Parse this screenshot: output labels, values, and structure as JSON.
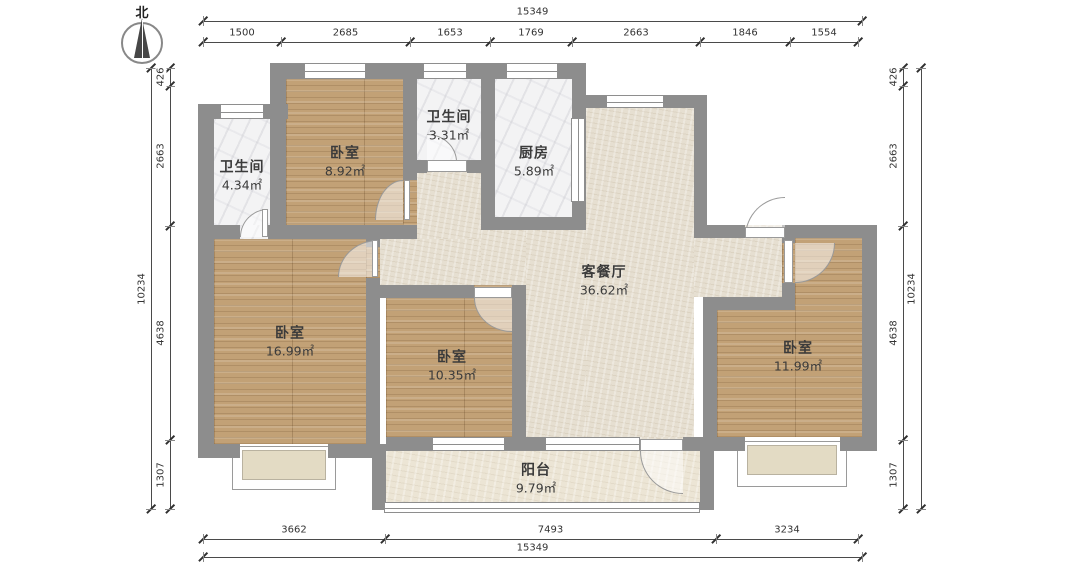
{
  "north": {
    "label": "北"
  },
  "colors": {
    "wall": "#8d8d8d",
    "wood_floor": "#c2a176",
    "tile_floor": "#f3f3f4",
    "living_floor": "#e6dfd1",
    "balcony_floor": "#ece5d5",
    "dim_line": "#4a4a4a",
    "label_text": "#3b3b3b"
  },
  "rooms": [
    {
      "id": "bath-master",
      "name": "卫生间",
      "area": "4.34㎡",
      "label": [
        242,
        176
      ],
      "floor_type": "tile",
      "floors": [
        [
          214,
          119,
          56,
          106
        ],
        [
          240,
          225,
          28,
          14
        ]
      ]
    },
    {
      "id": "bedroom-north",
      "name": "卧室",
      "area": "8.92㎡",
      "label": [
        345,
        162
      ],
      "floor_type": "wood",
      "floors": [
        [
          286,
          79,
          117,
          146
        ],
        [
          403,
          180,
          14,
          45
        ]
      ]
    },
    {
      "id": "bath-common",
      "name": "卫生间",
      "area": "3.31㎡",
      "label": [
        449,
        126
      ],
      "floor_type": "tile",
      "floors": [
        [
          417,
          79,
          64,
          81
        ]
      ]
    },
    {
      "id": "kitchen",
      "name": "厨房",
      "area": "5.89㎡",
      "label": [
        534,
        162
      ],
      "floor_type": "tile",
      "floors": [
        [
          495,
          79,
          77,
          138
        ]
      ]
    },
    {
      "id": "living-dining",
      "name": "客餐厅",
      "area": "36.62㎡",
      "label": [
        604,
        281
      ],
      "floor_type": "living",
      "floors": [
        [
          586,
          108,
          108,
          329
        ],
        [
          526,
          230,
          60,
          207
        ],
        [
          481,
          230,
          45,
          55
        ],
        [
          481,
          285,
          31,
          152
        ],
        [
          417,
          173,
          64,
          66
        ],
        [
          380,
          239,
          101,
          46
        ],
        [
          694,
          238,
          88,
          59
        ],
        [
          427,
          160,
          40,
          13
        ],
        [
          745,
          225,
          40,
          13
        ],
        [
          640,
          437,
          43,
          14
        ]
      ]
    },
    {
      "id": "bedroom-master",
      "name": "卧室",
      "area": "16.99㎡",
      "label": [
        290,
        342
      ],
      "floor_type": "wood",
      "floors": [
        [
          214,
          239,
          152,
          205
        ],
        [
          366,
          247,
          14,
          31
        ]
      ]
    },
    {
      "id": "bedroom-middle",
      "name": "卧室",
      "area": "10.35㎡",
      "label": [
        452,
        366
      ],
      "floor_type": "wood",
      "floors": [
        [
          386,
          298,
          126,
          139
        ],
        [
          474,
          285,
          38,
          13
        ]
      ]
    },
    {
      "id": "bedroom-east",
      "name": "卧室",
      "area": "11.99㎡",
      "label": [
        798,
        357
      ],
      "floor_type": "wood",
      "floors": [
        [
          795,
          238,
          67,
          72
        ],
        [
          717,
          310,
          145,
          127
        ],
        [
          782,
          243,
          13,
          40
        ]
      ]
    },
    {
      "id": "balcony",
      "name": "阳台",
      "area": "9.79㎡",
      "label": [
        536,
        479
      ],
      "floor_type": "balcony",
      "floors": [
        [
          386,
          451,
          314,
          54
        ]
      ]
    }
  ],
  "walls": [
    [
      198,
      104,
      90,
      15
    ],
    [
      198,
      104,
      16,
      354
    ],
    [
      270,
      63,
      16,
      176
    ],
    [
      286,
      63,
      300,
      16
    ],
    [
      572,
      63,
      14,
      167
    ],
    [
      586,
      95,
      121,
      13
    ],
    [
      694,
      95,
      13,
      143
    ],
    [
      694,
      225,
      51,
      13
    ],
    [
      785,
      225,
      92,
      13
    ],
    [
      862,
      225,
      15,
      226
    ],
    [
      198,
      444,
      42,
      14
    ],
    [
      328,
      444,
      58,
      14
    ],
    [
      372,
      444,
      14,
      66
    ],
    [
      386,
      437,
      46,
      14
    ],
    [
      505,
      437,
      40,
      14
    ],
    [
      683,
      437,
      34,
      14
    ],
    [
      700,
      451,
      14,
      59
    ],
    [
      703,
      437,
      42,
      14
    ],
    [
      840,
      437,
      37,
      14
    ],
    [
      403,
      79,
      14,
      101
    ],
    [
      286,
      225,
      131,
      14
    ],
    [
      214,
      225,
      26,
      14
    ],
    [
      268,
      225,
      18,
      14
    ],
    [
      417,
      160,
      10,
      13
    ],
    [
      467,
      160,
      28,
      13
    ],
    [
      481,
      79,
      14,
      151
    ],
    [
      481,
      217,
      105,
      13
    ],
    [
      366,
      239,
      14,
      8
    ],
    [
      366,
      278,
      14,
      166
    ],
    [
      366,
      285,
      108,
      13
    ],
    [
      512,
      285,
      14,
      13
    ],
    [
      512,
      285,
      14,
      152
    ],
    [
      703,
      297,
      92,
      13
    ],
    [
      703,
      310,
      14,
      127
    ],
    [
      782,
      225,
      13,
      18
    ],
    [
      782,
      283,
      13,
      27
    ]
  ],
  "bays": [
    {
      "frame": [
        232,
        446,
        104,
        44
      ],
      "inner": [
        242,
        450,
        84,
        30
      ]
    },
    {
      "frame": [
        737,
        441,
        110,
        46
      ],
      "inner": [
        747,
        445,
        90,
        30
      ]
    }
  ],
  "windows": [
    {
      "r": [
        220,
        104,
        44,
        15
      ],
      "dir": "h"
    },
    {
      "r": [
        304,
        63,
        62,
        16
      ],
      "dir": "h"
    },
    {
      "r": [
        423,
        63,
        44,
        16
      ],
      "dir": "h"
    },
    {
      "r": [
        506,
        63,
        52,
        16
      ],
      "dir": "h"
    },
    {
      "r": [
        606,
        95,
        58,
        13
      ],
      "dir": "h"
    },
    {
      "r": [
        571,
        118,
        14,
        84
      ],
      "dir": "v"
    },
    {
      "r": [
        432,
        437,
        73,
        14
      ],
      "dir": "h"
    },
    {
      "r": [
        545,
        437,
        95,
        14
      ],
      "dir": "h"
    },
    {
      "r": [
        384,
        502,
        316,
        11
      ],
      "dir": "h"
    }
  ],
  "doors": [
    {
      "arc": [
        240,
        209,
        28,
        28
      ],
      "corner": "tl",
      "leaf": [
        262,
        209,
        6,
        28
      ]
    },
    {
      "arc": [
        375,
        180,
        28,
        40
      ],
      "corner": "tl",
      "leaf": [
        404,
        180,
        6,
        40
      ]
    },
    {
      "arc": [
        427,
        134,
        30,
        28
      ],
      "corner": "tr",
      "leaf": [
        427,
        160,
        40,
        12
      ]
    },
    {
      "arc": [
        745,
        197,
        40,
        40
      ],
      "corner": "tl",
      "leaf": [
        745,
        227,
        40,
        11
      ]
    },
    {
      "arc": [
        338,
        240,
        40,
        37
      ],
      "corner": "tl",
      "leaf": [
        372,
        240,
        6,
        37
      ]
    },
    {
      "arc": [
        474,
        298,
        38,
        34
      ],
      "corner": "bl",
      "leaf": [
        474,
        287,
        38,
        11
      ]
    },
    {
      "arc": [
        795,
        243,
        40,
        40
      ],
      "corner": "br",
      "leaf": [
        784,
        240,
        9,
        43
      ]
    },
    {
      "arc": [
        640,
        451,
        43,
        43
      ],
      "corner": "bl",
      "leaf": [
        640,
        439,
        43,
        12
      ]
    }
  ],
  "dims": [
    {
      "id": "top-total",
      "axis": "h",
      "pos": 21,
      "side": "before",
      "segments": [
        {
          "label": "15349",
          "from": 203,
          "to": 862
        }
      ]
    },
    {
      "id": "top-segments",
      "axis": "h",
      "pos": 42,
      "side": "before",
      "segments": [
        {
          "label": "1500",
          "from": 203,
          "to": 281
        },
        {
          "label": "2685",
          "from": 281,
          "to": 410
        },
        {
          "label": "1653",
          "from": 410,
          "to": 490
        },
        {
          "label": "1769",
          "from": 490,
          "to": 572
        },
        {
          "label": "2663",
          "from": 572,
          "to": 700
        },
        {
          "label": "1846",
          "from": 700,
          "to": 790
        },
        {
          "label": "1554",
          "from": 790,
          "to": 858
        }
      ]
    },
    {
      "id": "bottom-segments",
      "axis": "h",
      "pos": 539,
      "side": "before",
      "segments": [
        {
          "label": "3662",
          "from": 203,
          "to": 385
        },
        {
          "label": "7493",
          "from": 385,
          "to": 716
        },
        {
          "label": "3234",
          "from": 716,
          "to": 858
        }
      ]
    },
    {
      "id": "bottom-total",
      "axis": "h",
      "pos": 557,
      "side": "before",
      "segments": [
        {
          "label": "15349",
          "from": 203,
          "to": 862
        }
      ]
    },
    {
      "id": "left-total",
      "axis": "v",
      "pos": 151,
      "side": "before",
      "segments": [
        {
          "label": "10234",
          "from": 68,
          "to": 509
        }
      ]
    },
    {
      "id": "left-segments",
      "axis": "v",
      "pos": 170,
      "side": "before",
      "segments": [
        {
          "label": "426",
          "from": 68,
          "to": 86
        },
        {
          "label": "2663",
          "from": 86,
          "to": 226
        },
        {
          "label": "4638",
          "from": 226,
          "to": 440
        },
        {
          "label": "1307",
          "from": 440,
          "to": 509
        }
      ]
    },
    {
      "id": "right-segments",
      "axis": "v",
      "pos": 903,
      "side": "before",
      "segments": [
        {
          "label": "426",
          "from": 68,
          "to": 86
        },
        {
          "label": "2663",
          "from": 86,
          "to": 226
        },
        {
          "label": "4638",
          "from": 226,
          "to": 440
        },
        {
          "label": "1307",
          "from": 440,
          "to": 509
        }
      ]
    },
    {
      "id": "right-total",
      "axis": "v",
      "pos": 921,
      "side": "before",
      "segments": [
        {
          "label": "10234",
          "from": 68,
          "to": 509
        }
      ]
    }
  ]
}
